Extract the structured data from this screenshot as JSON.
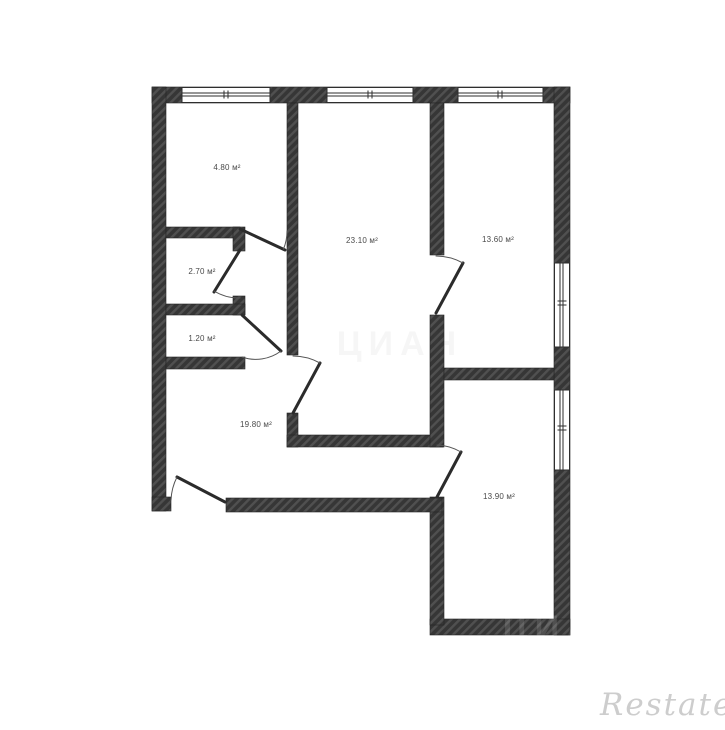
{
  "page": {
    "background": "#ffffff"
  },
  "floor_plan": {
    "kind": "apartment-floor-plan",
    "area_unit": "м²",
    "rooms": [
      {
        "id": "room-top-left",
        "area_label": "4.80 м²"
      },
      {
        "id": "room-center",
        "area_label": "23.10 м²"
      },
      {
        "id": "room-top-right",
        "area_label": "13.60 м²"
      },
      {
        "id": "closet-upper",
        "area_label": "2.70 м²"
      },
      {
        "id": "closet-lower",
        "area_label": "1.20 м²"
      },
      {
        "id": "hallway",
        "area_label": "19.80 м²"
      },
      {
        "id": "room-bottom-right",
        "area_label": "13.90 м²"
      }
    ],
    "counts": {
      "windows": 5,
      "doors": 7
    },
    "colors": {
      "wall_fill": "#363636",
      "wall_hatch": "#505050",
      "line": "#2e2e2e",
      "label_text": "#4a4a4a"
    }
  },
  "watermarks": {
    "restate": {
      "text": "Restate",
      "color": "#cdcdcd"
    },
    "cian_center": {
      "text": "ЦИАН"
    },
    "cian_bottom": {
      "text": "ЦИАН"
    }
  }
}
